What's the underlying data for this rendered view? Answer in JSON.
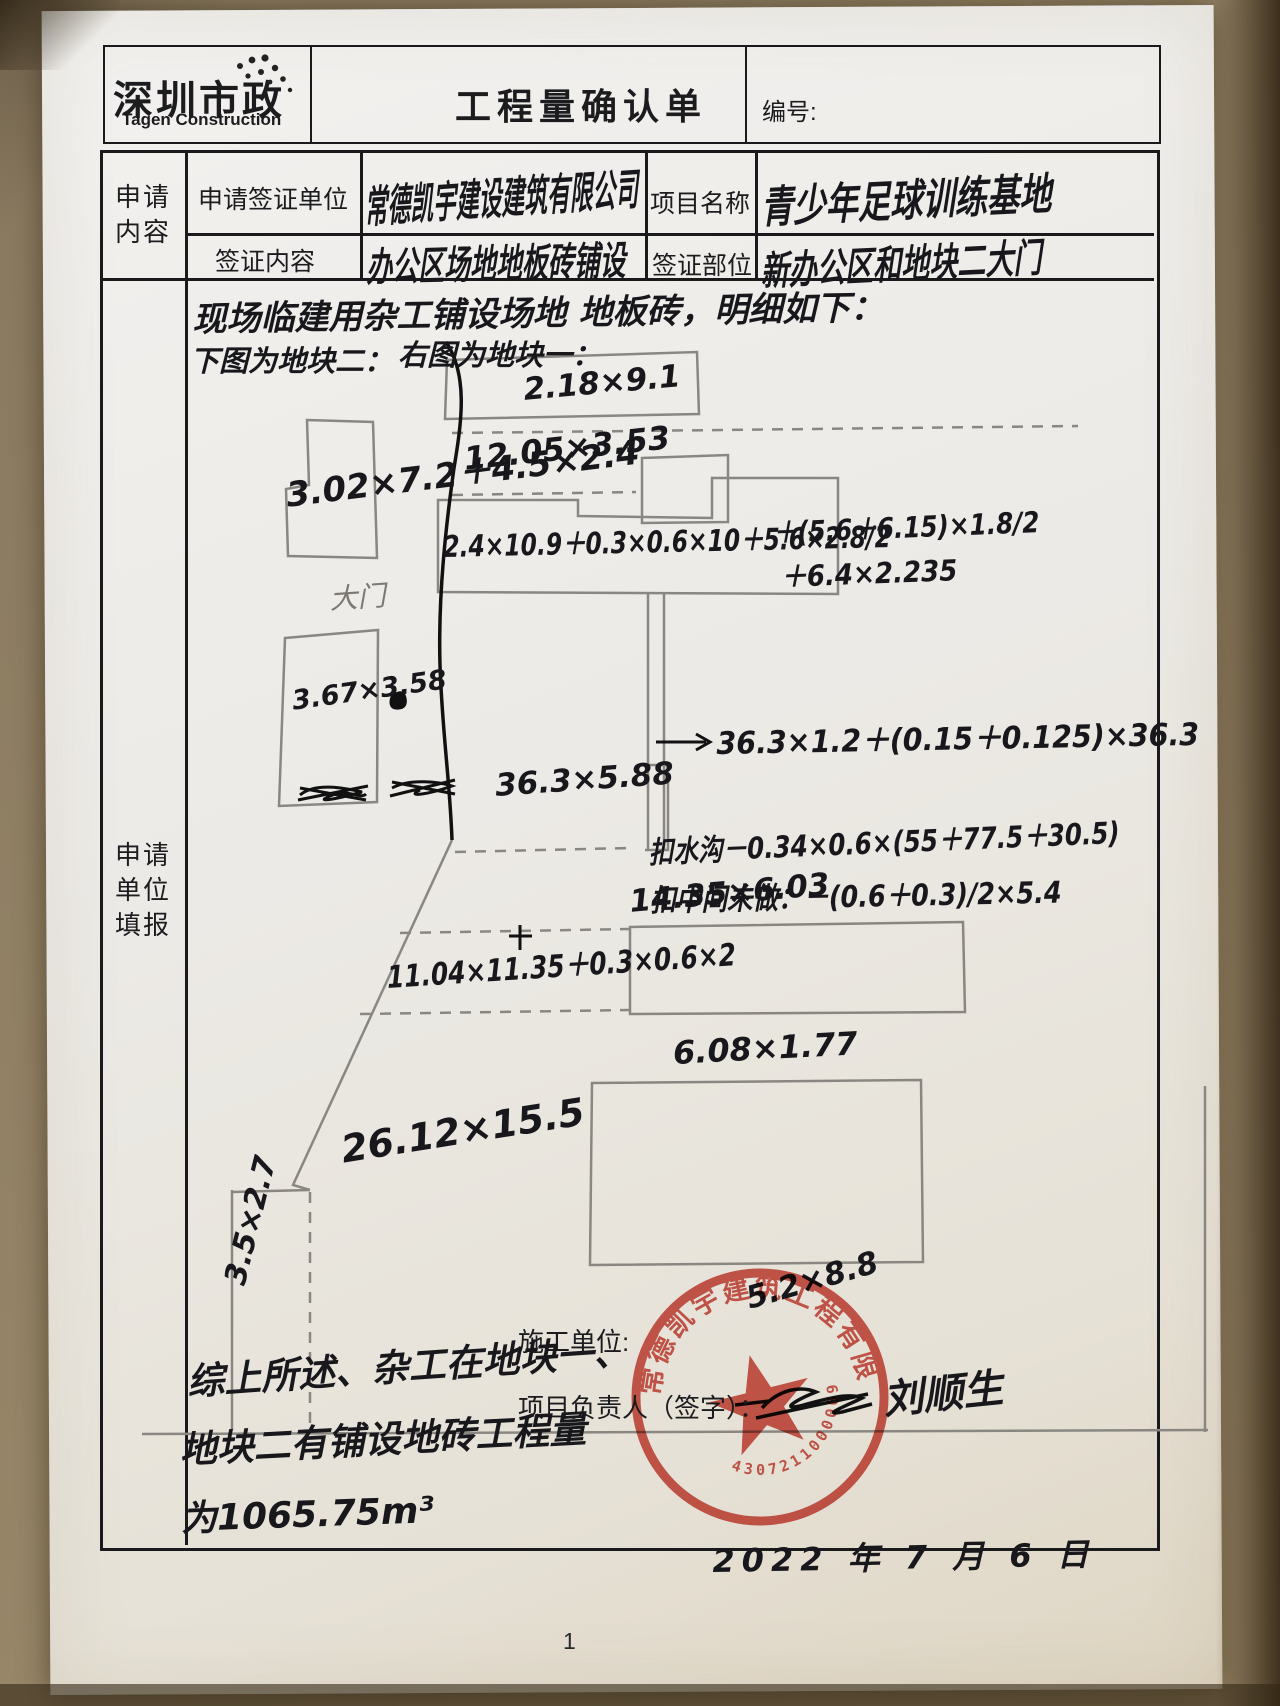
{
  "header": {
    "logo_cn": "深圳市政",
    "logo_en": "Tagen Construction",
    "title": "工程量确认单",
    "number_label": "编号:"
  },
  "form": {
    "left_label_top": "申请\n内容",
    "left_label_main": "申请\n单位\n填报",
    "apply_unit_label": "申请签证单位",
    "apply_unit_value": "常德凯宇建设建筑有限公司",
    "project_label": "项目名称",
    "project_value": "青少年足球训练基地",
    "content_label": "签证内容",
    "content_value": "办公区场地地板砖铺设",
    "location_label": "签证部位",
    "location_value": "新办公区和地块二大门"
  },
  "diagram": {
    "intro": "现场临建用杂工铺设场地 地板砖，明细如下：",
    "legend_left": "下图为地块二：",
    "legend_right": "右图为地块一：",
    "gate_label": "大门",
    "block2_shape1": "3.02×7.2＋4.5×2.4",
    "block2_shape2": "3.67×3.58",
    "block2_shape3": "36.3×5.88",
    "a_top": "2.18×9.1",
    "a_row2": "12.05×3.53",
    "a_formula1": "2.4×10.9＋0.3×0.6×10＋5.6×2.8/2",
    "a_formula1b": "＋(5.6＋6.15)×1.8/2",
    "a_formula1c": "＋6.4×2.235",
    "a_strip": "36.3×1.2＋(0.15＋0.125)×36.3",
    "a_deduct1": "扣水沟－0.34×0.6×(55＋77.5＋30.5)",
    "a_deduct2": "扣中间未做：－(0.6＋0.3)/2×5.4",
    "a_mid1": "14.35×6.03",
    "a_mid2": "11.04×11.35＋0.3×0.6×2",
    "a_mid3": "6.08×1.77",
    "a_big": "26.12×15.5",
    "a_small_left": "3.5×2.7",
    "a_on_stamp": "5.2×8.8"
  },
  "footer": {
    "summary_line1": "综上所述、杂工在地块一、",
    "summary_line2": "地块二有铺设地砖工程量",
    "summary_line3": "为1065.75m³",
    "builder_label": "施工单位:",
    "manager_label": "项目负责人（签字）：",
    "signature": "刘顺生",
    "date": "2022 年 7 月 6 日",
    "page_number": "1"
  },
  "stamp": {
    "company": "常德凯宇建筑工程有限公司",
    "number": "43072110000690",
    "color": "#c8382c"
  }
}
